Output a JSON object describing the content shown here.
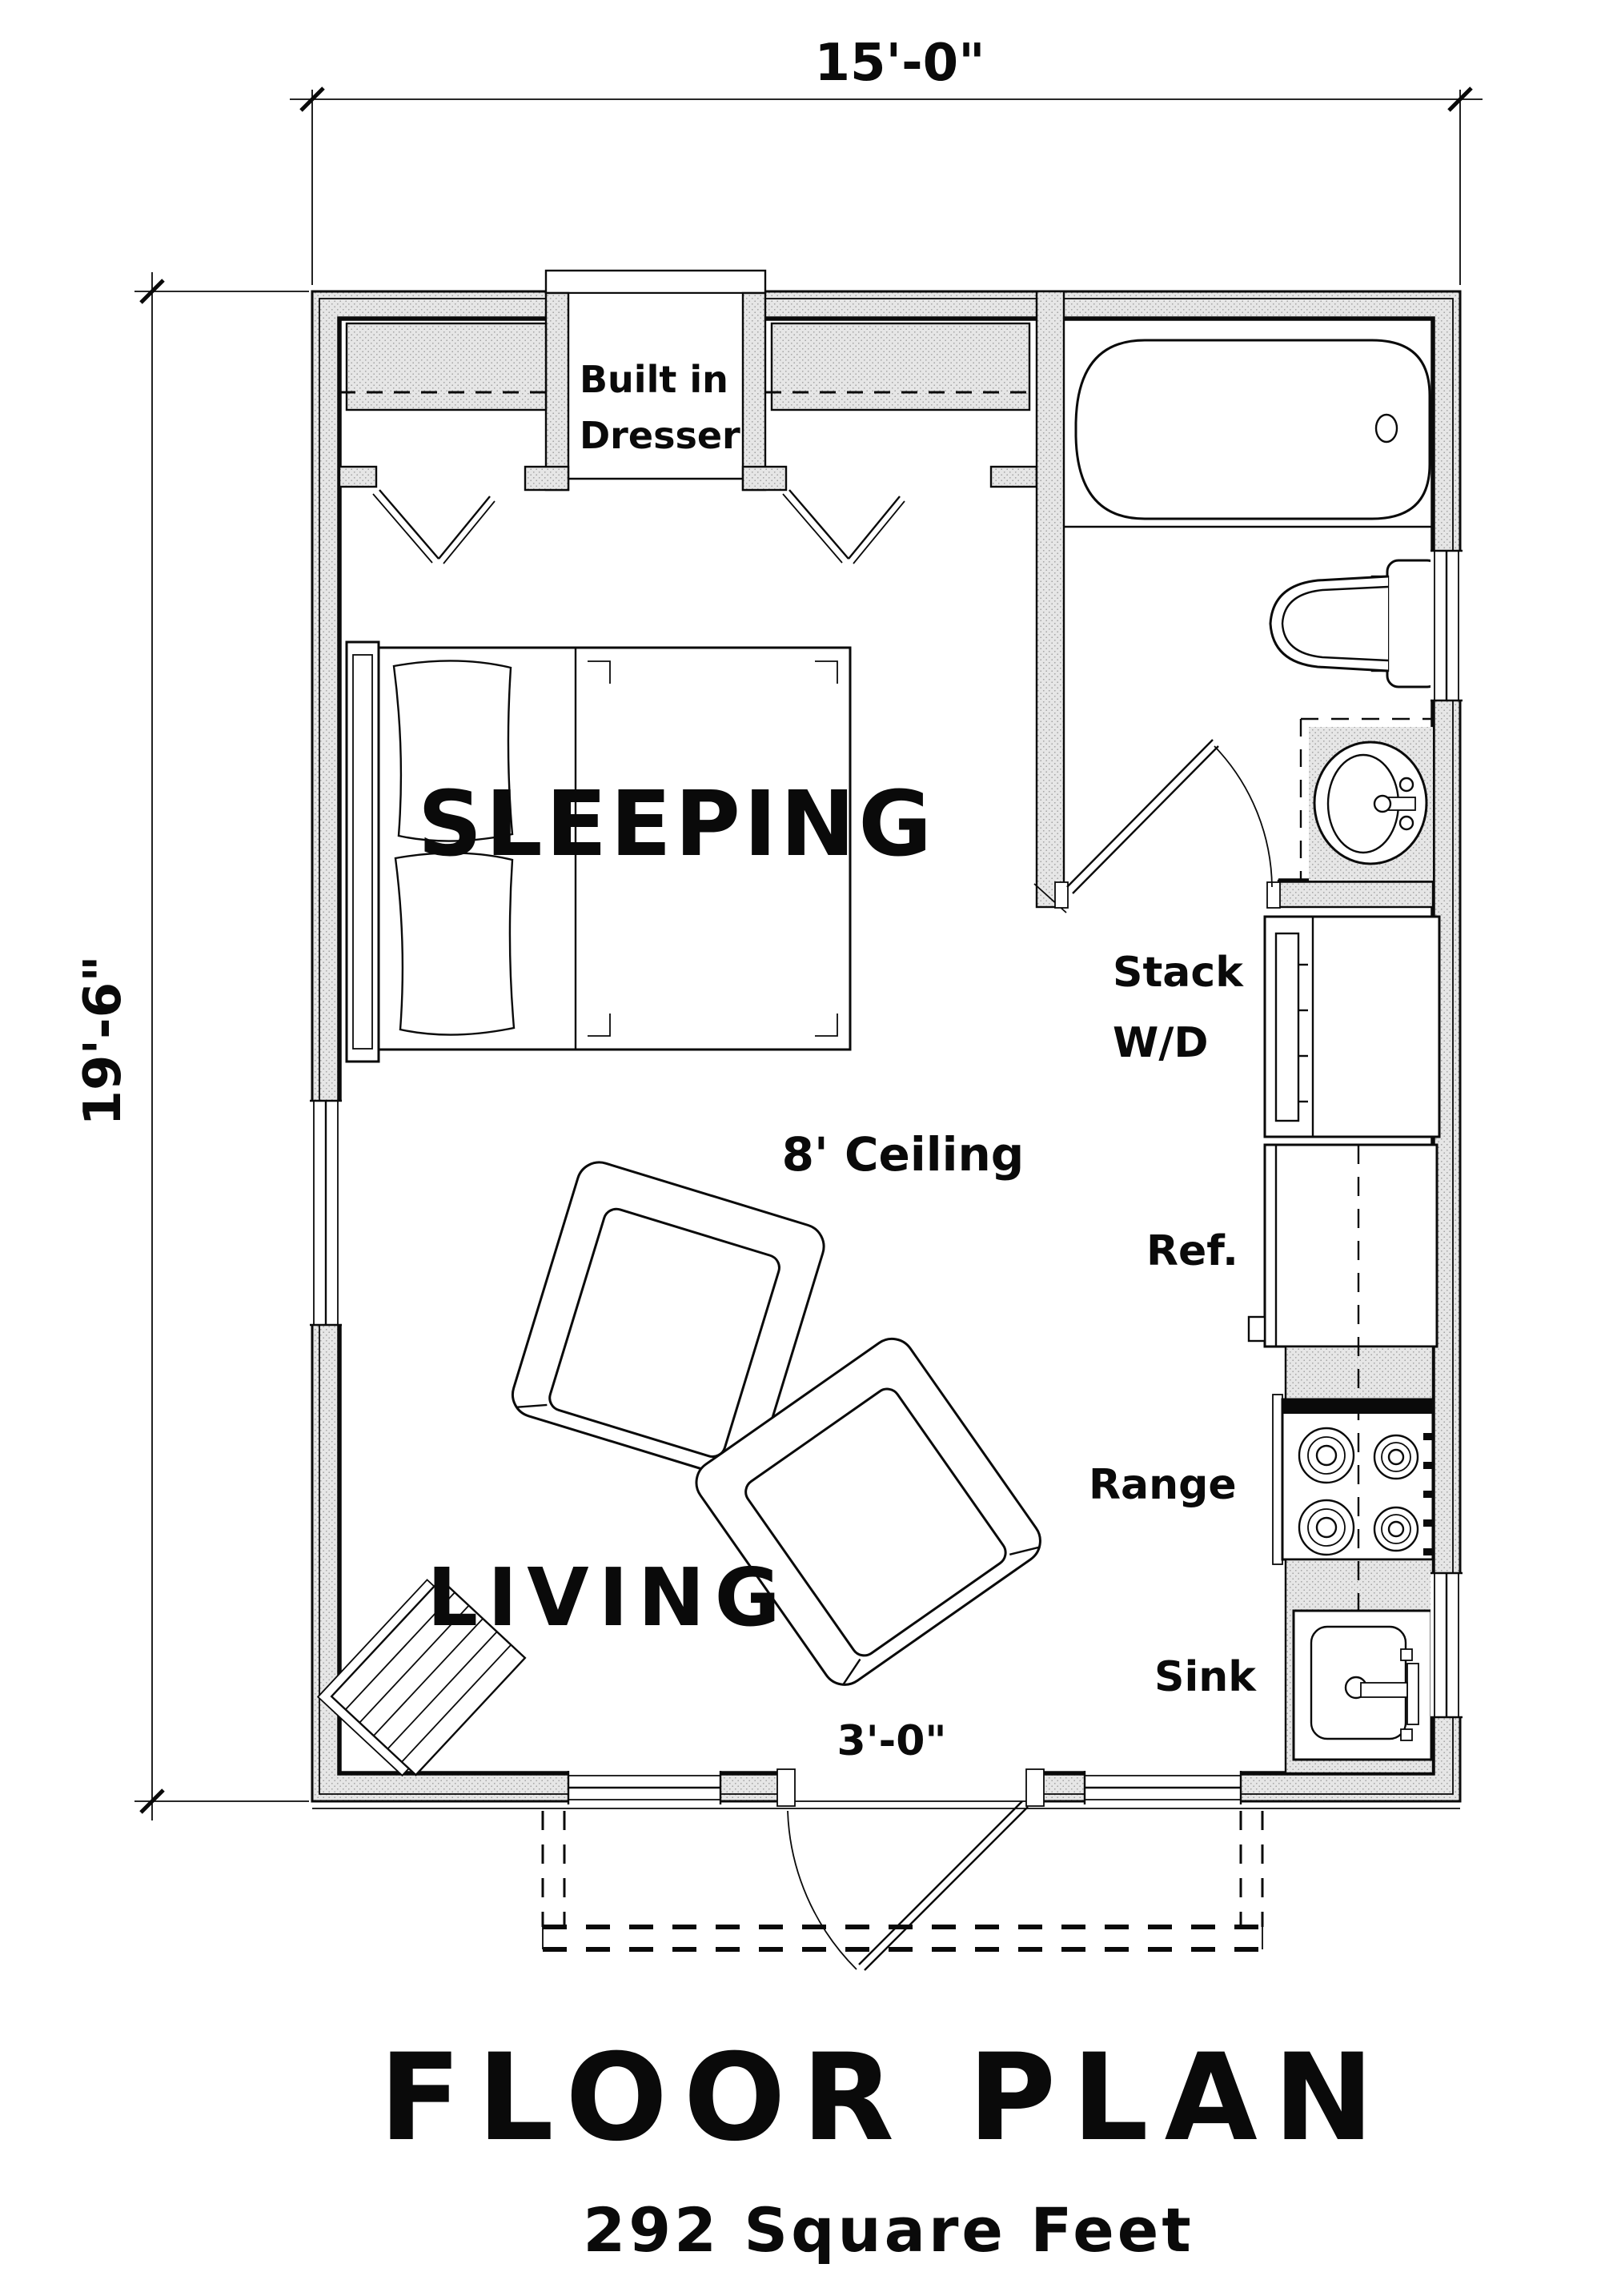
{
  "plan": {
    "title": "FLOOR PLAN",
    "subtitle": "292 Square Feet",
    "dims": {
      "width": "15'-0\"",
      "depth": "19'-6\"",
      "door": "3'-0\""
    },
    "rooms": {
      "sleeping": "SLEEPING",
      "living": "LIVING",
      "ceiling": "8' Ceiling"
    },
    "labels": {
      "dresser1": "Built in",
      "dresser2": "Dresser",
      "laundry1": "Stack",
      "laundry2": "W/D",
      "fridge": "Ref.",
      "range": "Range",
      "sink": "Sink"
    },
    "colors": {
      "line": "#0a0a0a",
      "wall_fill": "#e6e6e6",
      "background": "#ffffff"
    }
  }
}
